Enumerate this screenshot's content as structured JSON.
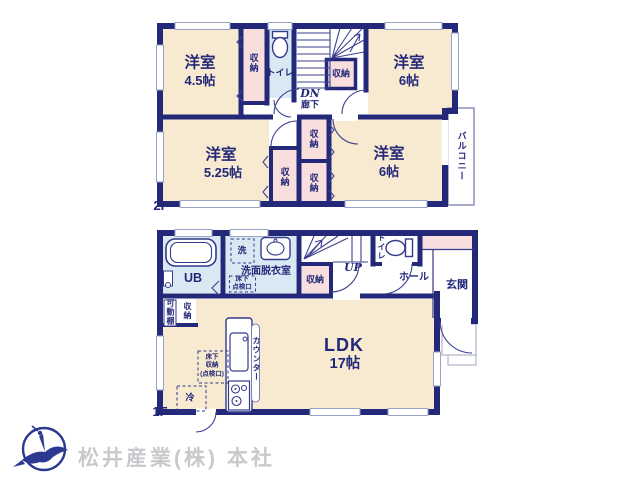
{
  "colors": {
    "wall": "#232878",
    "bedroom_fill": "#f7ead0",
    "closet_fill": "#f9dede",
    "wet_area_fill": "#d9e9f3",
    "line": "#3c4190",
    "window_frame": "#9aa3c4",
    "logo": "#2b3990",
    "watermark_text": "#c9c9cd"
  },
  "floor2": {
    "floor_label": "2F",
    "bedroom_45": {
      "name": "洋室",
      "area": "4.5帖"
    },
    "bedroom_6_top": {
      "name": "洋室",
      "area": "6帖"
    },
    "bedroom_525": {
      "name": "洋室",
      "area": "5.25帖"
    },
    "bedroom_6_bottom": {
      "name": "洋室",
      "area": "6帖"
    },
    "toilet": "トイレ",
    "closet_a": "収納",
    "closet_b": "収納",
    "closet_c": "収納",
    "closet_d": "収納",
    "closet_e": "収納",
    "stairs_down": "DN",
    "hallway": "廊下",
    "balcony": "バルコニー"
  },
  "floor1": {
    "floor_label": "1F",
    "unit_bath": "UB",
    "washer": "洗",
    "washroom": "洗面脱衣室",
    "underfloor_hatch": "床下\n点検口",
    "storage": "収納",
    "stairs_up": "UP",
    "toilet": "トイレ",
    "hall": "ホール",
    "entrance": "玄関",
    "movable_shelf": "可動棚",
    "shelf_storage": "収納",
    "counter": "カウンター",
    "underfloor_storage": "床下\n収納\n(点検口)",
    "fridge": "冷",
    "ldk": {
      "name": "LDK",
      "area": "17帖"
    }
  },
  "footer": {
    "company": "松井産業(株) 本社"
  }
}
